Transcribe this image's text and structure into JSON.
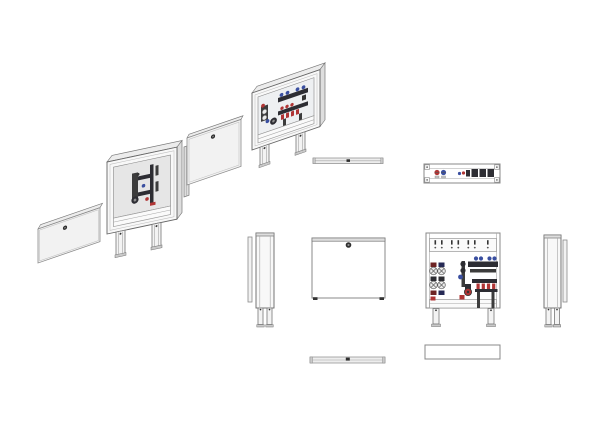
{
  "page": {
    "background": "#ffffff",
    "description": "Technical drawing of a floor-heating manifold cabinet: exploded isometric view plus orthographic projections (top, front, side, bottom views)."
  },
  "palette": {
    "line": "#777777",
    "line-dark": "#444444",
    "panel": "#f5f5f5",
    "panel-shade": "#dedede",
    "panel-top": "#ececec",
    "opening": "#e6e6e6",
    "dark": "#2d2d33",
    "red": "#b03535",
    "blue": "#3a4fa0",
    "white": "#ffffff",
    "bg": "#ffffff"
  },
  "views": {
    "exploded": {
      "name": "exploded-isometric-view",
      "parts": [
        "door-panel",
        "frame-cabinet-with-manifold",
        "mounting-rail",
        "cover-frame-panel",
        "assembled-cabinet"
      ]
    },
    "cover_top_view": {
      "name": "cover-top-view"
    },
    "cabinet_top_view": {
      "name": "cabinet-top-view-open"
    },
    "side_view_left": {
      "name": "side-view-left"
    },
    "front_view_closed": {
      "name": "front-view-closed"
    },
    "front_view_open": {
      "name": "front-view-open"
    },
    "side_view_right": {
      "name": "side-view-right"
    },
    "door_top_view": {
      "name": "door-top-view"
    },
    "cabinet_bottom_view": {
      "name": "cabinet-bottom-view"
    }
  },
  "counts": {
    "slot_groups_on_rail": 4,
    "blue_actuator_caps": 4,
    "red_flow_meters": 4,
    "valve_circles_left_group": 4,
    "legs_per_cabinet": 2,
    "locks_visible": 4
  }
}
